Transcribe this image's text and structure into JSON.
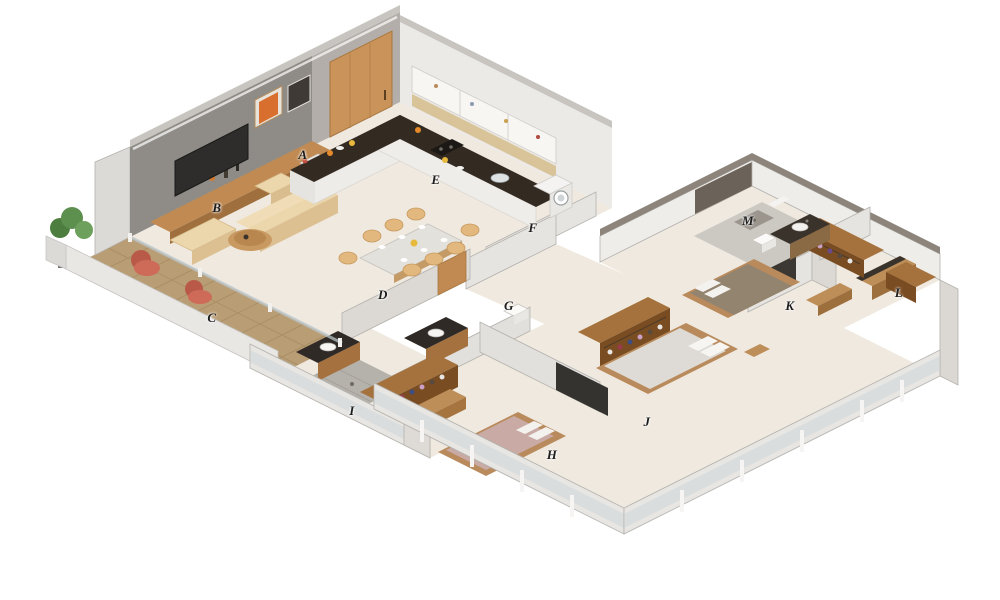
{
  "labels": [
    {
      "id": "a",
      "char": "A"
    },
    {
      "id": "b",
      "char": "B"
    },
    {
      "id": "c",
      "char": "C"
    },
    {
      "id": "d",
      "char": "D"
    },
    {
      "id": "e",
      "char": "E"
    },
    {
      "id": "f",
      "char": "F"
    },
    {
      "id": "g",
      "char": "G"
    },
    {
      "id": "h",
      "char": "H"
    },
    {
      "id": "i",
      "char": "I"
    },
    {
      "id": "j",
      "char": "J"
    },
    {
      "id": "k",
      "char": "K"
    },
    {
      "id": "l",
      "char": "L"
    },
    {
      "id": "m",
      "char": "M"
    }
  ],
  "palette": {
    "background": "#ffffff",
    "floor": "#efe9e0",
    "deck_wood": "#b99d74",
    "accent_wall_gray": "#8f8b86",
    "wall_white": "#eceae6",
    "wall_top_gray": "#8d857c",
    "counter_dark": "#332a22",
    "cabinet_wood": "#c08a52",
    "wardrobe_wood": "#7a4c22",
    "sofa_beige": "#ecd6ac",
    "dining_chair_tan": "#e2b87e",
    "balcony_chair_coral": "#cd6a58",
    "plant_green": "#5d8f4e",
    "bed_h_mauve": "#c9aaa4",
    "bed_j_white": "#dedbd6",
    "bed_k_taupe": "#93846f",
    "glass_blue": "#ccd4d7",
    "label_ink": "#1c1c1c"
  }
}
